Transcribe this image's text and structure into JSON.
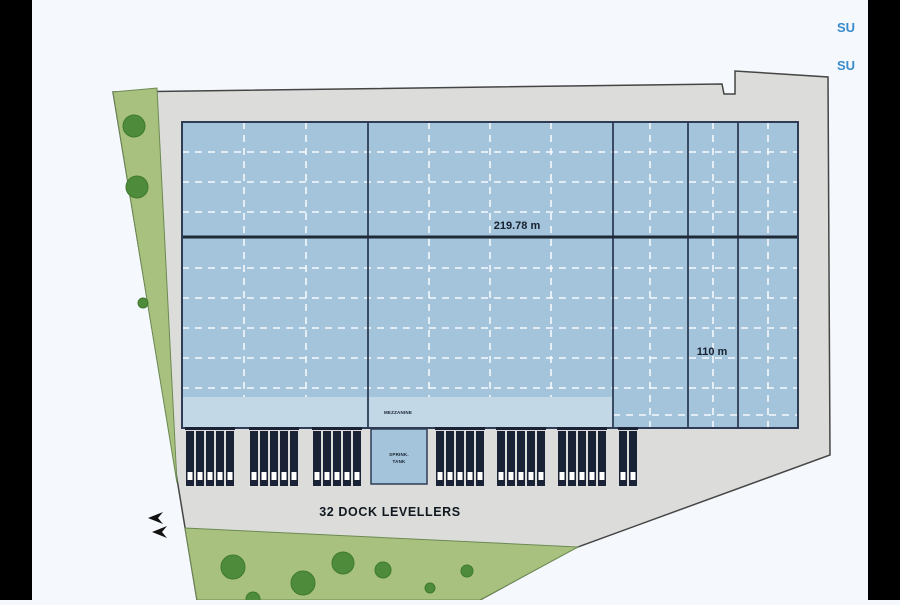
{
  "colors": {
    "background": "#f5f8fc",
    "letterbox": "#000000",
    "plot_gray": "#dcdddb",
    "plot_outline": "#454545",
    "landscape_green": "#a9c17e",
    "tree_green": "#4e8c3c",
    "building_blue": "#a3c4da",
    "apron_blue": "#c3d8e6",
    "building_outline": "#2e3d55",
    "dock_navy": "#1a2336",
    "corner_text_blue": "#3a8ccc"
  },
  "labels": {
    "width_dimension": "219.78 m",
    "height_dimension": "110 m",
    "dock_levellers": "32 DOCK LEVELLERS",
    "apron_small": "MEZZANINE",
    "tank_line1": "SPRINK.",
    "tank_line2": "TANK",
    "corner_top": "SU",
    "corner_bottom": "SU"
  }
}
